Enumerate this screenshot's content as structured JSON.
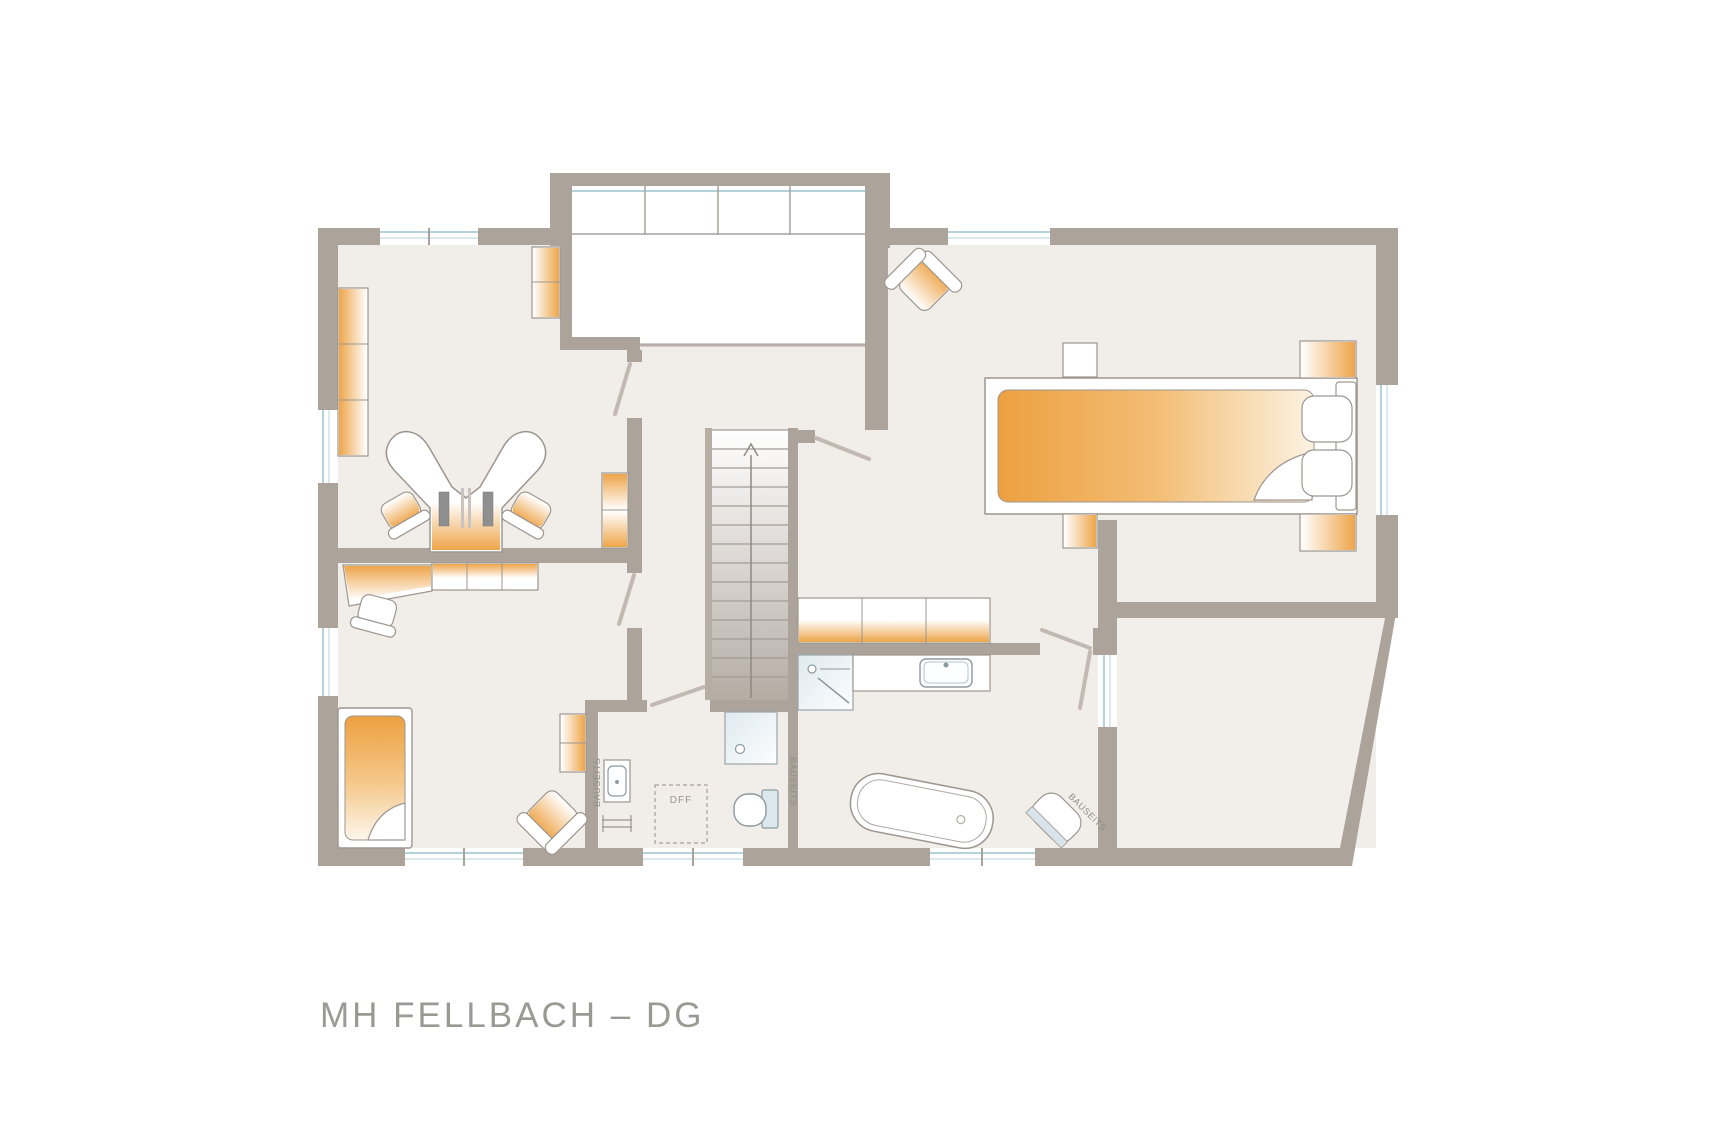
{
  "title": "MH FELLBACH – DG",
  "labels": {
    "bauseits_wc_basin": "BAUSEITS",
    "bauseits_wc_shower": "BAUSEITS",
    "bauseits_bath_basin": "BAUSEITS",
    "roof_window": "DFF"
  },
  "colors": {
    "wall": "#aca39b",
    "wall_light": "#b6ada5",
    "floor": "#f1ede9",
    "floor_annex": "#f2efeb",
    "accent_orange": "#eda040",
    "window_glass": "#b3d2dc",
    "sanitary_blue": "#dfeaef",
    "stairs_dark": "#b5aca4",
    "text_gray": "#9a9a95"
  },
  "furniture_icons": [
    "wardrobe-icon",
    "double-workstation-desk-icon",
    "office-chair-icon",
    "cabinet-icon",
    "desk-icon",
    "sideboard-icon",
    "single-bed-icon",
    "armchair-icon",
    "staircase-up-arrow-icon",
    "gallery-railing-icon",
    "double-bed-icon",
    "nightstand-icon",
    "side-table-icon",
    "chest-icon",
    "wardrobe-row-icon",
    "shower-icon",
    "vanity-sink-icon",
    "bathtub-icon",
    "corner-basin-icon",
    "washbasin-icon",
    "towel-radiator-icon",
    "toilet-icon",
    "roof-window-icon",
    "door-swing-icon",
    "window-icon"
  ]
}
